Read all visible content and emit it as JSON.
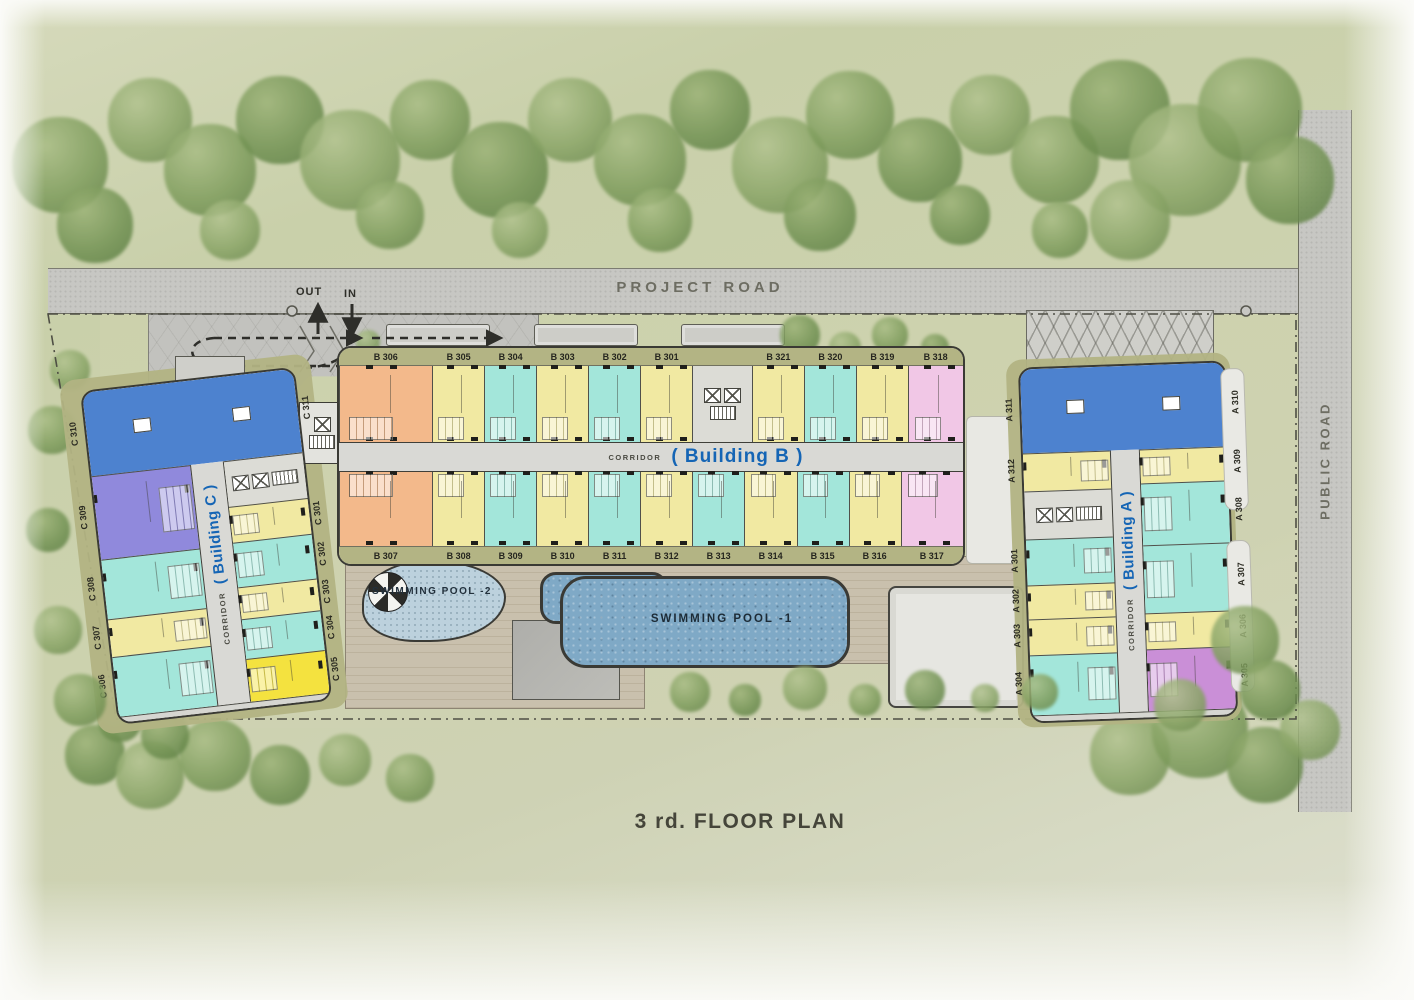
{
  "title": "3 rd. FLOOR PLAN",
  "roads": {
    "project": "PROJECT ROAD",
    "public": "PUBLIC ROAD"
  },
  "circulation": {
    "out": "OUT",
    "in": "IN"
  },
  "pools": {
    "pool1": {
      "label": "SWIMMING POOL -1"
    },
    "pool2": {
      "label": "SWIMMING POOL -2"
    }
  },
  "palette": {
    "orange": "#f3b98b",
    "yellow": "#f1e9a2",
    "teal": "#a3e6da",
    "pink": "#f1c7e6",
    "blue": "#4d82cf",
    "purple": "#9089dc",
    "magenta": "#ca8fd7",
    "bright_yellow": "#f4e23f",
    "core": "#dcdcd6"
  },
  "building_b": {
    "corridor_label": "CORRIDOR",
    "name": "( Building B )",
    "top_units": [
      {
        "label": "B 306",
        "color": "orange",
        "w": 1.8
      },
      {
        "label": "B 305",
        "color": "yellow",
        "w": 1
      },
      {
        "label": "B 304",
        "color": "teal",
        "w": 1
      },
      {
        "label": "B 303",
        "color": "yellow",
        "w": 1
      },
      {
        "label": "B 302",
        "color": "teal",
        "w": 1
      },
      {
        "label": "B 301",
        "color": "yellow",
        "w": 1
      },
      {
        "label": "",
        "color": "core",
        "w": 1.15
      },
      {
        "label": "B 321",
        "color": "yellow",
        "w": 1
      },
      {
        "label": "B 320",
        "color": "teal",
        "w": 1
      },
      {
        "label": "B 319",
        "color": "yellow",
        "w": 1
      },
      {
        "label": "B 318",
        "color": "pink",
        "w": 1.05
      }
    ],
    "bottom_units": [
      {
        "label": "B 307",
        "color": "orange",
        "w": 1.8
      },
      {
        "label": "B 308",
        "color": "yellow",
        "w": 1
      },
      {
        "label": "B 309",
        "color": "teal",
        "w": 1
      },
      {
        "label": "B 310",
        "color": "yellow",
        "w": 1
      },
      {
        "label": "B 311",
        "color": "teal",
        "w": 1
      },
      {
        "label": "B 312",
        "color": "yellow",
        "w": 1
      },
      {
        "label": "B 313",
        "color": "teal",
        "w": 1
      },
      {
        "label": "B 314",
        "color": "yellow",
        "w": 1
      },
      {
        "label": "B 315",
        "color": "teal",
        "w": 1
      },
      {
        "label": "B 316",
        "color": "yellow",
        "w": 1
      },
      {
        "label": "B 317",
        "color": "pink",
        "w": 1.2
      }
    ]
  },
  "building_c": {
    "corridor_label": "CORRIDOR",
    "name": "( Building C )",
    "top_unit": {
      "left_label": "C 310",
      "right_label": "C 311",
      "color": "blue",
      "h": 84
    },
    "left_units": [
      {
        "label": "C 309",
        "color": "purple",
        "h": 84
      },
      {
        "label": "C 308",
        "color": "teal",
        "h": 60
      },
      {
        "label": "C 307",
        "color": "yellow",
        "h": 38
      },
      {
        "label": "C 306",
        "color": "teal",
        "h": 60
      }
    ],
    "right_units": [
      {
        "label": "",
        "color": "core",
        "h": 46
      },
      {
        "label": "C 301",
        "color": "yellow",
        "h": 36
      },
      {
        "label": "C 302",
        "color": "teal",
        "h": 45
      },
      {
        "label": "C 303",
        "color": "yellow",
        "h": 32
      },
      {
        "label": "C 304",
        "color": "teal",
        "h": 40
      },
      {
        "label": "C 305",
        "color": "bright_yellow",
        "h": 43
      }
    ]
  },
  "building_a": {
    "corridor_label": "CORRIDOR",
    "name": "( Building A )",
    "top_unit": {
      "left_label": "A 311",
      "right_label": "A 310",
      "color": "blue",
      "h": 84
    },
    "left_units": [
      {
        "label": "A 312",
        "color": "yellow",
        "h": 38
      },
      {
        "label": "",
        "color": "core",
        "h": 48
      },
      {
        "label": "A 301",
        "color": "teal",
        "h": 46
      },
      {
        "label": "A 302",
        "color": "yellow",
        "h": 34
      },
      {
        "label": "A 303",
        "color": "yellow",
        "h": 36
      },
      {
        "label": "A 304",
        "color": "teal",
        "h": 60
      }
    ],
    "right_units": [
      {
        "label": "A 309",
        "color": "yellow",
        "h": 34
      },
      {
        "label": "A 308",
        "color": "teal",
        "h": 62
      },
      {
        "label": "A 307",
        "color": "teal",
        "h": 68
      },
      {
        "label": "A 306",
        "color": "yellow",
        "h": 36
      },
      {
        "label": "A 305",
        "color": "magenta",
        "h": 62
      }
    ]
  }
}
